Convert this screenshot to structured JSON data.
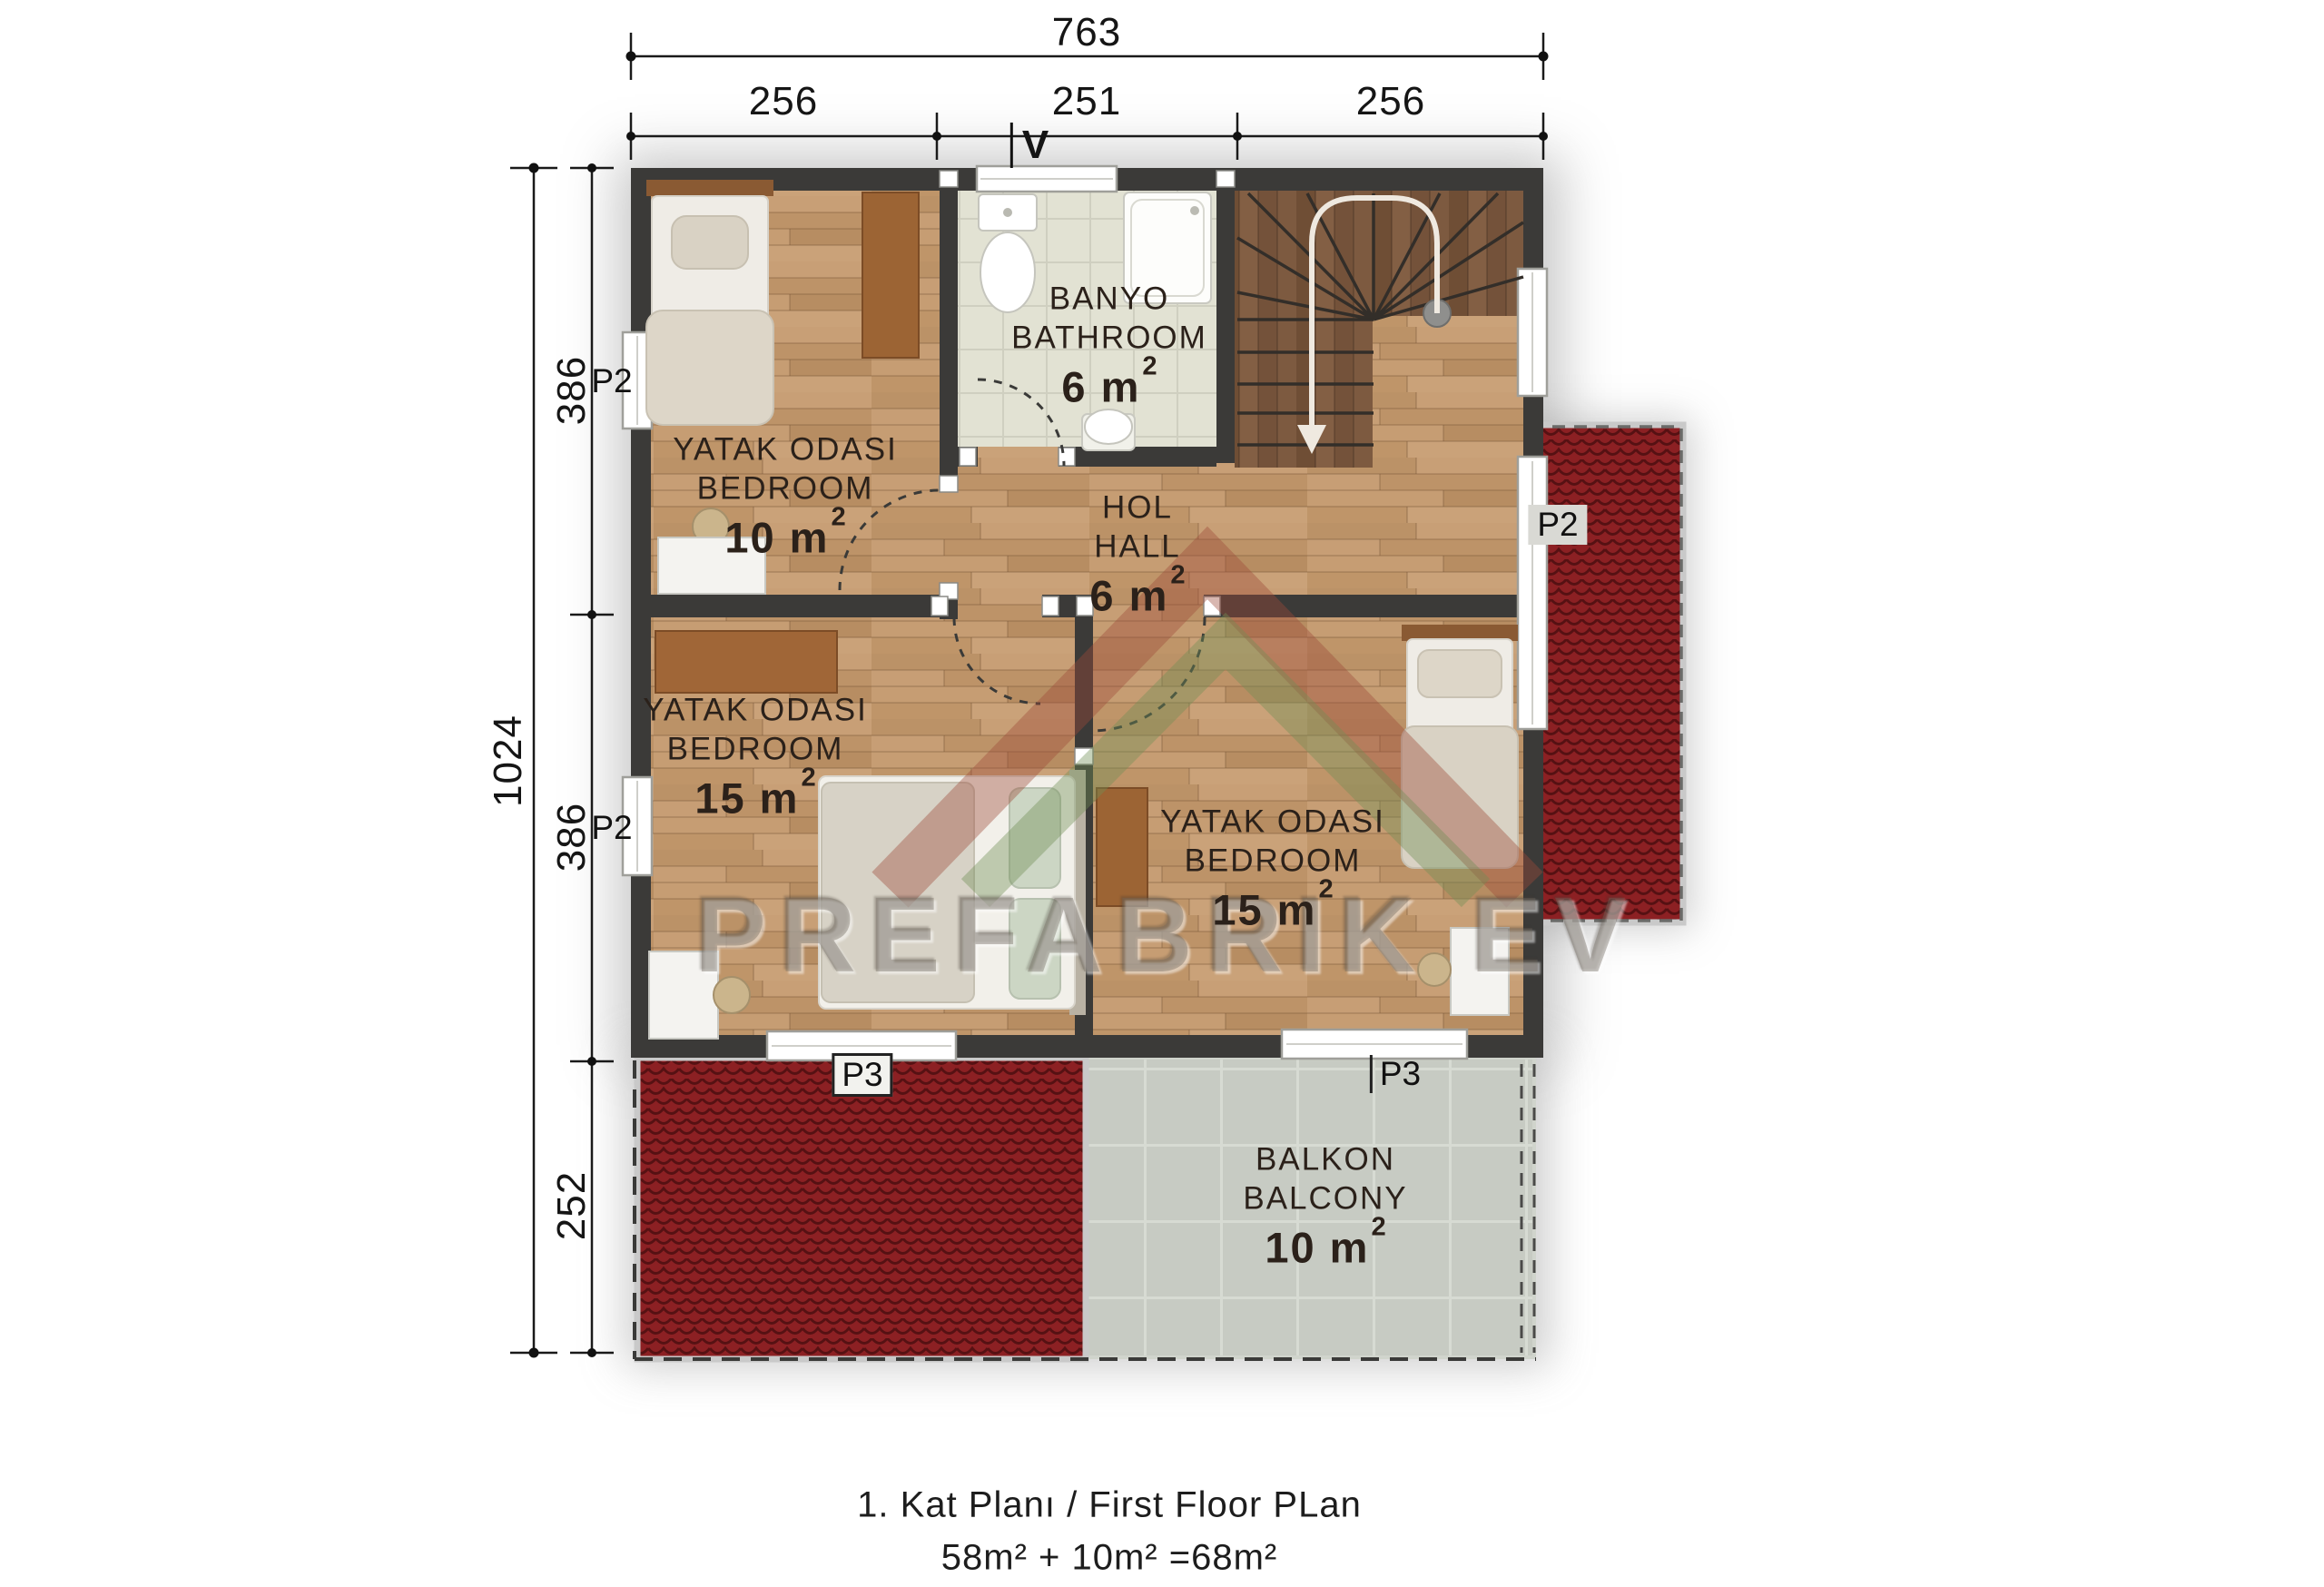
{
  "palette": {
    "wall": "#3b3a38",
    "roof_red": "#8c2023",
    "wood_floor": "#c39b70",
    "wood_dark": "#7a573c",
    "bath_tile": "#e2e2d3",
    "balcony_tile": "#c7cbc3"
  },
  "dimensions": {
    "top": {
      "total": "763",
      "segments": [
        "256",
        "251",
        "256"
      ]
    },
    "left": {
      "total": "1024",
      "segments": [
        "386",
        "386",
        "252"
      ]
    }
  },
  "markers": {
    "p2": "P2",
    "p3": "P3",
    "vent": "V"
  },
  "rooms": {
    "bedroom_top": {
      "name_tr": "YATAK ODASI",
      "name_en": "BEDROOM",
      "area_base": "10 m",
      "area_sup": "2"
    },
    "bathroom": {
      "name_tr": "BANYO",
      "name_en": "BATHROOM",
      "area_base": "6 m",
      "area_sup": "2"
    },
    "hall": {
      "name_tr": "HOL",
      "name_en": "HALL",
      "area_base": "6 m",
      "area_sup": "2"
    },
    "bedroom_left": {
      "name_tr": "YATAK ODASI",
      "name_en": "BEDROOM",
      "area_base": "15 m",
      "area_sup": "2"
    },
    "bedroom_right": {
      "name_tr": "YATAK ODASI",
      "name_en": "BEDROOM",
      "area_base": "15 m",
      "area_sup": "2"
    },
    "balcony": {
      "name_tr": "BALKON",
      "name_en": "BALCONY",
      "area_base": "10 m",
      "area_sup": "2"
    }
  },
  "caption": {
    "title": "1. Kat Planı / First Floor PLan",
    "area_sum": "58m² + 10m² =68m²"
  },
  "watermark": {
    "text": "PREFABRIK EV"
  }
}
